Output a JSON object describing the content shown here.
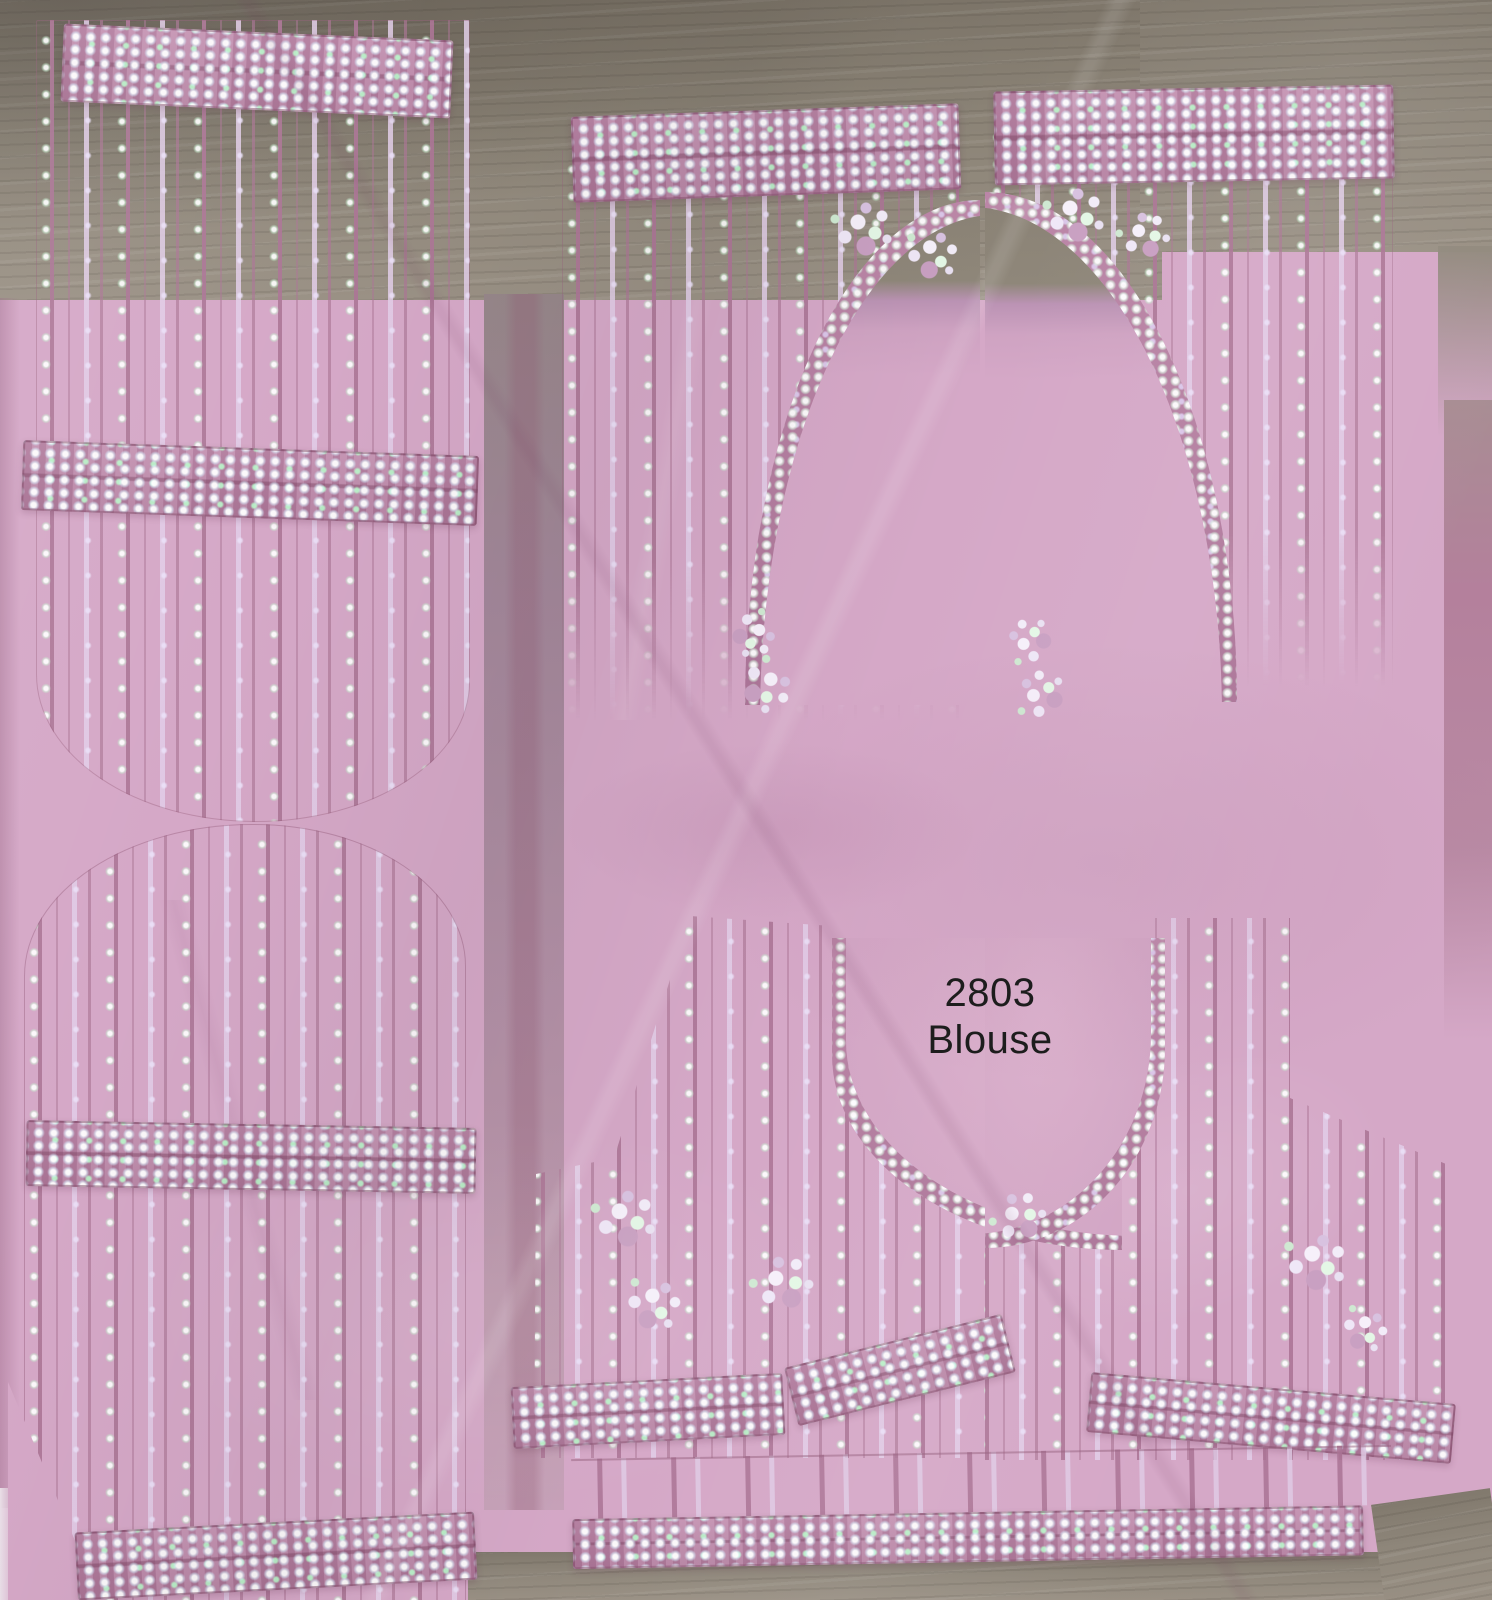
{
  "photo": {
    "label": {
      "code": "2803",
      "name": "Blouse"
    },
    "colors": {
      "lining_pink": "#d5a8c7",
      "net_gray": "#8e8679",
      "thread_mauve": "#b27e9e",
      "sequin_white": "#f2ecf8",
      "sequin_green": "#cdeed2",
      "sequin_lavender": "#d9c9ec",
      "label_text": "#1d1d1d"
    }
  }
}
